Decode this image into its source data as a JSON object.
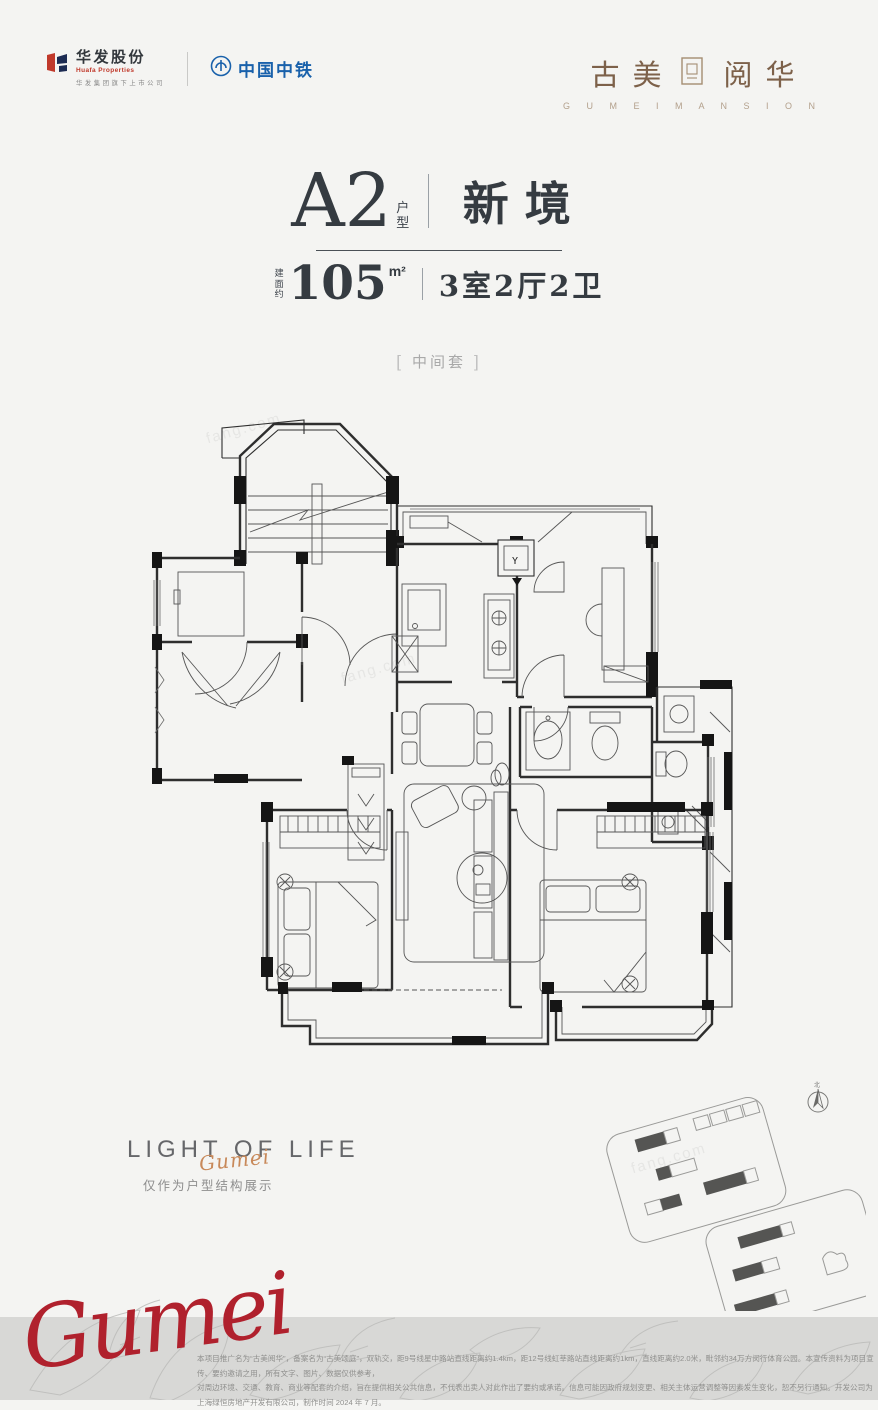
{
  "colors": {
    "background": "#f4f4f2",
    "band_gray": "#d8d8d6",
    "title_dark": "#353b41",
    "huafa_red": "#c0392b",
    "crec_blue": "#1961ab",
    "brand_brown": "#7d614a",
    "brand_tan": "#b3a08c",
    "script_red": "#b0212d"
  },
  "header": {
    "huafa": {
      "name": "华发股份",
      "en": "Huafa Properties",
      "tagline": "华发集团旗下上市公司"
    },
    "crec": {
      "name": "中国中铁"
    },
    "brand": {
      "cn_left": "古美",
      "cn_right": "阅华",
      "en": "G U M E I   M A N S I O N"
    }
  },
  "title": {
    "unit": "A2",
    "unit_type": "户型",
    "name": "新境",
    "area_prefix": "建面约",
    "area_value": "105",
    "area_unit": "m²",
    "rooms": "3室2厅2卫",
    "tag_open": "[",
    "tag_text": "中间套",
    "tag_close": "]"
  },
  "floorplan": {
    "shaft_label": "Y",
    "watermark": "fang.com"
  },
  "caption": {
    "slogan": "LIGHT OF LIFE",
    "script": "Gumei",
    "note": "仅作为户型结构展示"
  },
  "siteplan": {
    "compass_label": "北"
  },
  "footer": {
    "script": "Gumei",
    "disclaimer_line1": "本项目推广名为“古美阅华”，备案名为“古美颂庭”，双轨交，距9号线星中路站直线距离约1.4km，距12号线虹莘路站直线距离约1km，直线距离约2.0米，毗邻约34万方闵行体育公园。本宣传资料为项目宣传、要约邀请之用，所有文字、图片、数据仅供参考，",
    "disclaimer_line2": "对周边环境、交通、教育、商业等配套的介绍，旨在提供相关公共信息，不代表出卖人对此作出了要约或承诺。信息可能因政府规划变更、相关主体运营调整等因素发生变化，恕不另行通知。开发公司为上海绿恒房地产开发有限公司，制作时间 2024 年 7 月。"
  }
}
